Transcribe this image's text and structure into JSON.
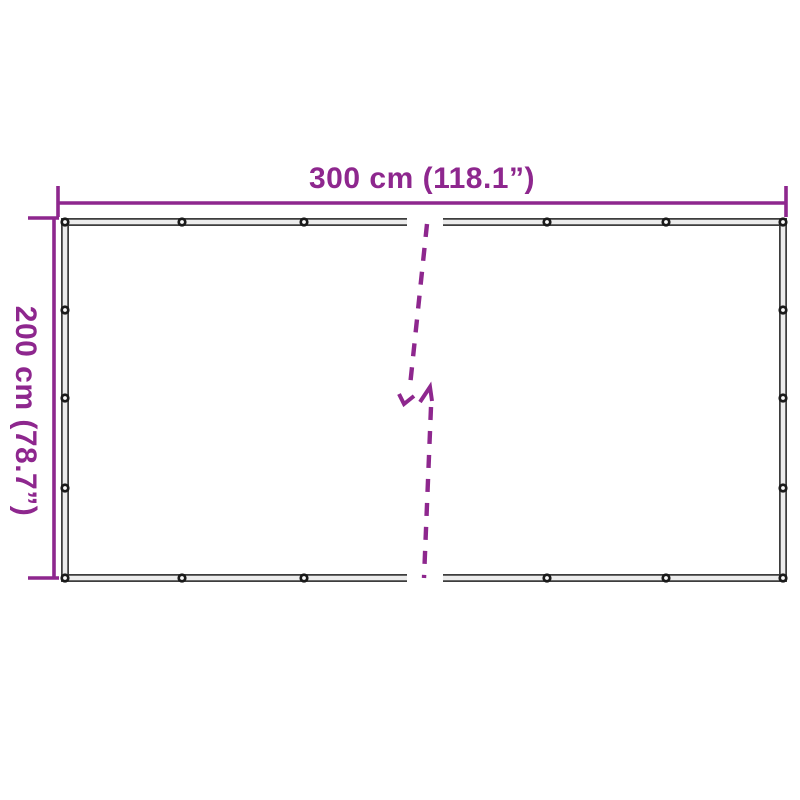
{
  "diagram": {
    "width_label": "300 cm (118.1”)",
    "height_label": "200 cm (78.7”)",
    "eyelet_count_visible": 18,
    "eyelets": [
      [
        65,
        222
      ],
      [
        182,
        222
      ],
      [
        304,
        222
      ],
      [
        547,
        222
      ],
      [
        666,
        222
      ],
      [
        783,
        222
      ],
      [
        65,
        578
      ],
      [
        182,
        578
      ],
      [
        304,
        578
      ],
      [
        547,
        578
      ],
      [
        666,
        578
      ],
      [
        783,
        578
      ],
      [
        65,
        310
      ],
      [
        65,
        398
      ],
      [
        65,
        488
      ],
      [
        783,
        310
      ],
      [
        783,
        398
      ],
      [
        783,
        488
      ]
    ],
    "colors": {
      "dimension_accent": "#8E278E",
      "frame_dark": "#3d3d3d",
      "frame_light": "#ececec",
      "grommet_dark": "#1a1a1a",
      "grommet_center": "#fafafa",
      "background": "#ffffff"
    }
  }
}
